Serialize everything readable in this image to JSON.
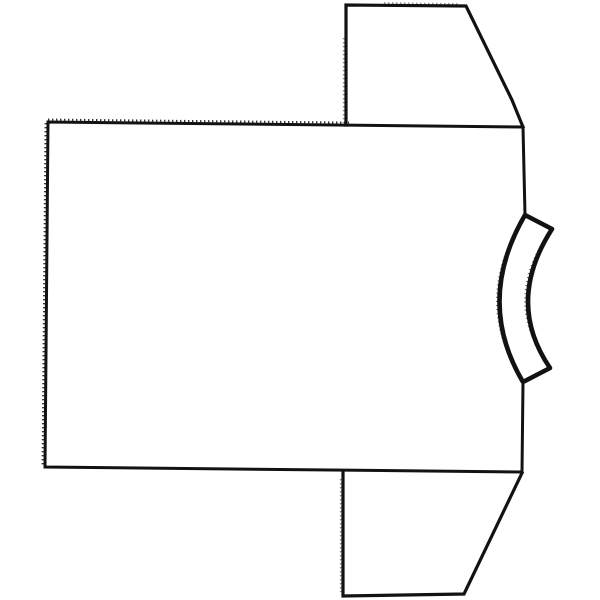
{
  "figure": {
    "subject": "line drawing of a short-sleeve t-shirt rotated 90 degrees, neckband on the right side, sleeves pointing up and down",
    "colors": {
      "paper": "#ffffff",
      "ink": "#121212"
    },
    "canvas": {
      "width": 600,
      "height": 600
    },
    "shapes": {
      "body": {
        "label": "shirt body panel outline (right edge interrupted by neckband)",
        "path": "M525,215 L523,127 L48,122 L45,467 L522,472 L523,383"
      },
      "top_sleeve": {
        "label": "upper sleeve trapezoid",
        "path": "M346,125 L346,5 L466,6 L512,100 L523,127"
      },
      "bottom_sleeve": {
        "label": "lower sleeve trapezoid",
        "path": "M343,473 L343,596 L464,594 L522,473"
      },
      "collar": {
        "label": "curved neckband crescent",
        "path": "M525,215 L552,229 Q505,302 550,368 L523,382 Q475,301 525,215 Z"
      }
    },
    "textures": {
      "top_edge_stitch": {
        "label": "jagged stitch marks above body top edge",
        "path": "M48,119.6 L349,122.6"
      },
      "left_edge_stitch": {
        "label": "jagged stitch marks left of body left edge",
        "path": "M45.6,123 L42.6,466"
      },
      "top_sleeve_left_stitch": {
        "label": "dotted marks left of upper sleeve edge",
        "path": "M343.8,38 L343.8,123"
      },
      "bottom_sleeve_left_stitch": {
        "label": "dotted marks left of lower sleeve edge",
        "path": "M340.9,479 L340.9,592"
      },
      "top_sleeve_top_marks": {
        "label": "faint marks above upper sleeve top edge",
        "path": "M384,3.2 L459,4.2"
      },
      "collar_outer_fuzz": {
        "label": "rough sketch texture along neckband outer curve",
        "path": "M521.5,379 Q471.5,300 523.5,219"
      },
      "collar_inner_fuzz": {
        "label": "rough sketch texture along neckband inner curve",
        "path": "M547.5,363 Q502,301 549,233"
      }
    }
  }
}
